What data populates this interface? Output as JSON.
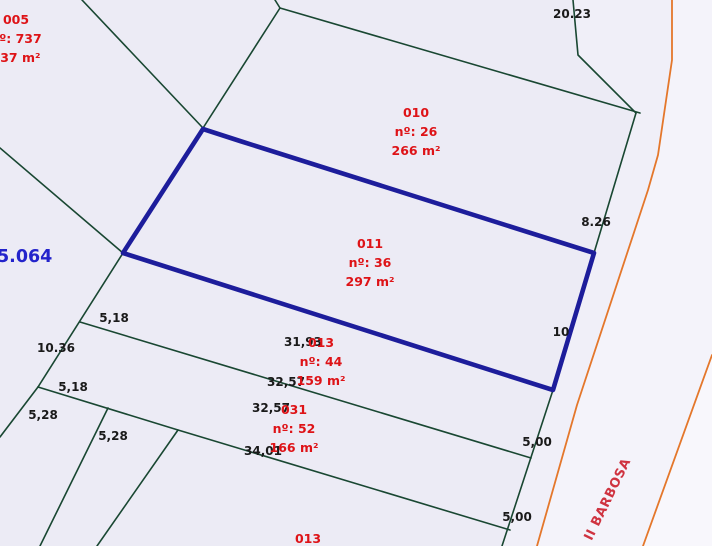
{
  "map_view": {
    "colors": {
      "background": "#ecebf5",
      "boundary_line": "#194732",
      "road_edge_line": "#e4772b",
      "selected_parcel": "#1d1d9b",
      "parcel_text": "#de1317",
      "measure_text": "#1a1a1a",
      "plan_text": "#2323cb",
      "street_text": "#cf3340",
      "verge_fill": "#f0eff8",
      "road_fill": "#f4f3fa",
      "outside_fill": "#f8f7fc"
    },
    "plan_label": {
      "text": "5.064"
    },
    "street_label": {
      "text": "II BARBOSA",
      "angle_deg": -64
    },
    "parcels": [
      {
        "code": "005",
        "number_line": "nº: 737",
        "area_line": "337 m²",
        "cx": 16,
        "cy": 10,
        "highlighted": false
      },
      {
        "code": "010",
        "number_line": "nº: 26",
        "area_line": "266 m²",
        "cx": 416,
        "cy": 103,
        "highlighted": false
      },
      {
        "code": "011",
        "number_line": "nº: 36",
        "area_line": "297 m²",
        "cx": 370,
        "cy": 234,
        "highlighted": true
      },
      {
        "code": "013",
        "number_line": "nº: 44",
        "area_line": "159 m²",
        "cx": 321,
        "cy": 333,
        "highlighted": false
      },
      {
        "code": "031",
        "number_line": "nº: 52",
        "area_line": "166 m²",
        "cx": 294,
        "cy": 400,
        "highlighted": false
      },
      {
        "code": "013",
        "number_line": "",
        "area_line": "",
        "cx": 308,
        "cy": 529,
        "highlighted": false
      }
    ],
    "measurements": [
      {
        "text": "20.23",
        "cx": 572,
        "cy": 14
      },
      {
        "text": "8.26",
        "cx": 596,
        "cy": 222
      },
      {
        "text": "10",
        "cx": 561,
        "cy": 332
      },
      {
        "text": "5,18",
        "cx": 114,
        "cy": 318
      },
      {
        "text": "10.36",
        "cx": 56,
        "cy": 348
      },
      {
        "text": "5,18",
        "cx": 73,
        "cy": 387
      },
      {
        "text": "5,28",
        "cx": 43,
        "cy": 415
      },
      {
        "text": "5,28",
        "cx": 113,
        "cy": 436
      },
      {
        "text": "31,93",
        "cx": 303,
        "cy": 342
      },
      {
        "text": "32,57",
        "cx": 286,
        "cy": 382
      },
      {
        "text": "32,57",
        "cx": 271,
        "cy": 408
      },
      {
        "text": "34,01",
        "cx": 263,
        "cy": 451
      },
      {
        "text": "5,00",
        "cx": 537,
        "cy": 442
      },
      {
        "text": "5,00",
        "cx": 517,
        "cy": 517
      }
    ],
    "selected_parcel_outline": "203,129 240,141 594,253 553,390 123,253",
    "boundary_lines": [
      "82,0 203,128",
      "275,0 280,8",
      "280,8 203,128",
      "280,8 640,113",
      "573,0 578,55 636,113",
      "636,113 594,253 553,390 502,546",
      "0,148 123,253",
      "123,253 38,387",
      "38,387 0,437",
      "80,322 531,458",
      "38,387 178,430 510,530",
      "178,430 97,546",
      "108,408 40,546"
    ],
    "road_edge_lines": [
      "672,0 672,60 658,155 648,190 577,405 537,546",
      "712,355 643,546"
    ],
    "fill_areas": {
      "verge": "573,0 578,55 636,113 594,253 553,390 502,546 537,546 577,405 648,190 658,155 672,60 672,0",
      "road": "672,0 672,60 658,155 648,190 577,405 537,546 643,546 712,355 712,0",
      "outside_right": "712,355 643,546 712,546"
    }
  }
}
